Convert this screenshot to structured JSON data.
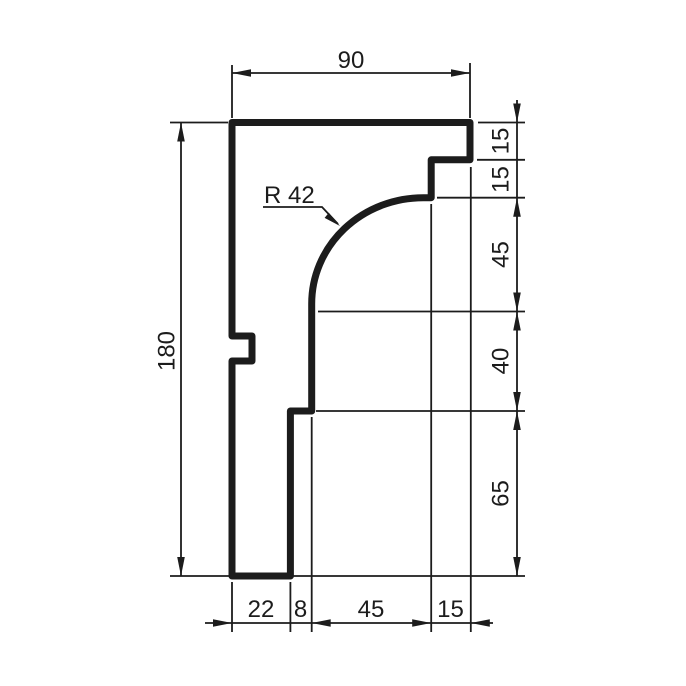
{
  "drawing": {
    "kind": "molding-profile-cross-section",
    "colors": {
      "line": "#1c1c1c",
      "background": "#ffffff"
    },
    "dims": {
      "top_width": "90",
      "left_height": "180",
      "right_segments": [
        "15",
        "15",
        "45",
        "40",
        "65"
      ],
      "bottom_segments": [
        "22",
        "8",
        "45",
        "15"
      ],
      "radius_label": "R 42"
    }
  }
}
